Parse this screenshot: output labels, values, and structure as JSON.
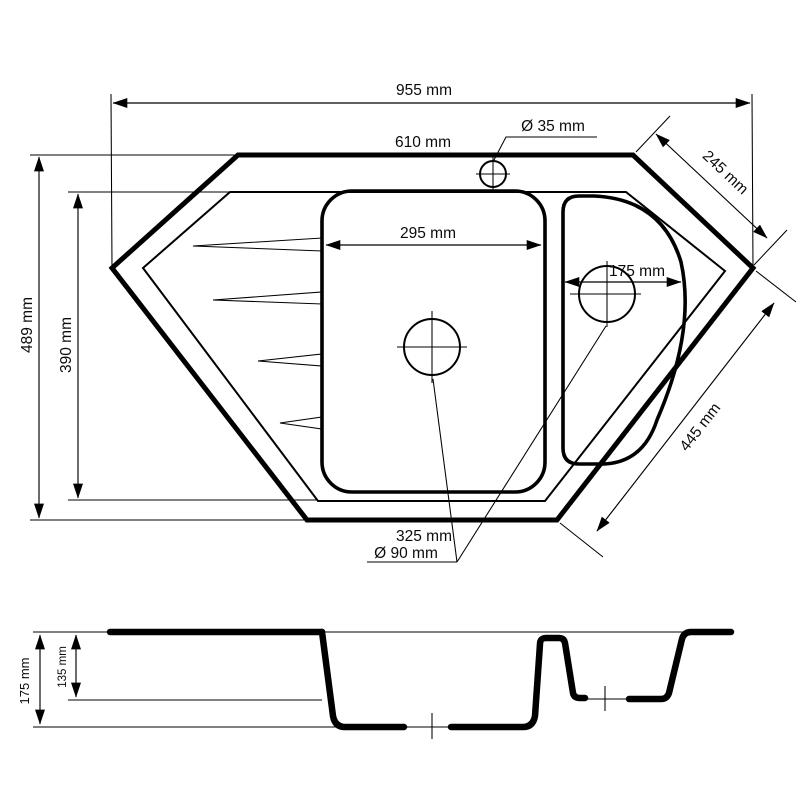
{
  "drawing": {
    "type": "technical-dimension-drawing",
    "subject": "corner kitchen sink, top view and section view",
    "colors": {
      "ink": "#000000",
      "background": "#ffffff"
    }
  },
  "top_view": {
    "dimensions": {
      "overall_width": "955 mm",
      "top_edge_width": "610 mm",
      "tap_hole_diameter": "Ø 35 mm",
      "top_right_edge": "245 mm",
      "main_basin_width": "295 mm",
      "small_basin_width": "175 mm",
      "overall_depth": "489 mm",
      "inner_depth": "390 mm",
      "bottom_right_edge": "445 mm",
      "bottom_edge_width": "325 mm",
      "drain_diameter": "Ø 90 mm"
    }
  },
  "section_view": {
    "dimensions": {
      "main_bowl_depth": "175 mm",
      "small_bowl_depth": "135 mm"
    }
  }
}
